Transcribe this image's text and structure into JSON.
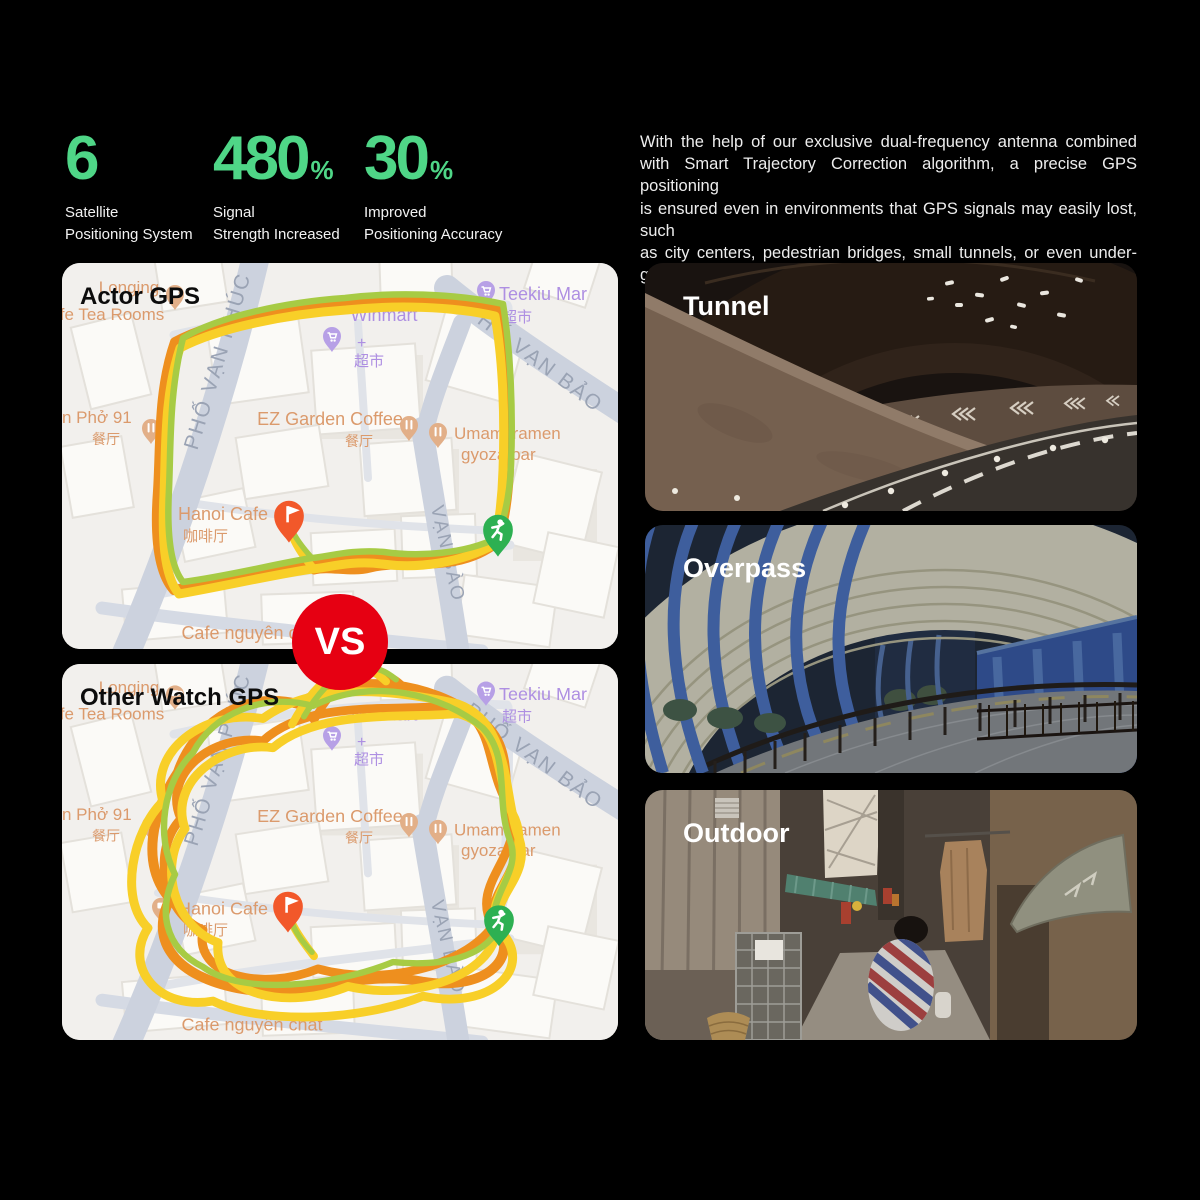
{
  "page": {
    "background": "#000000"
  },
  "stats": {
    "accent_color": "#4fd687",
    "items": [
      {
        "value": "6",
        "suffix": "",
        "label": "Satellite\nPositioning System"
      },
      {
        "value": "480",
        "suffix": "%",
        "label": "Signal\nStrength Increased"
      },
      {
        "value": "30",
        "suffix": "%",
        "label": "Improved\nPositioning Accuracy"
      }
    ]
  },
  "intro": {
    "lines": [
      "With the help of our exclusive dual-frequency antenna combined",
      "with Smart Trajectory Correction algorithm, a precise GPS positioning",
      "is ensured even in environments that GPS signals may easily lost, such",
      "as city centers, pedestrian bridges, small tunnels, or even under-",
      "ground passages."
    ]
  },
  "comparison": {
    "vs": "VS",
    "vs_color": "#e60012",
    "map_top": {
      "title": "Actor GPS"
    },
    "map_bottom": {
      "title": "Other Watch GPS"
    }
  },
  "map_pois": {
    "longing1": "Longing",
    "longing2": "fe Tea Rooms",
    "winmart": "Winmart",
    "winmart_plus": "+",
    "winmart_cn": "超市",
    "teekiu": "Teekiu Mar",
    "teekiu_cn": "超市",
    "pho": "n Phở 91",
    "pho_cn": "餐厅",
    "ez": "EZ Garden Coffee",
    "ez_cn": "餐厅",
    "umami1": "Umami ramen",
    "umami2": "gyoza bar",
    "hanoi": "Hanoi Cafe",
    "hanoi_cn": "咖啡厅",
    "cafe_nguyen": "Cafe nguyên chất",
    "street_phuc": "PHỐ VẠN PHÚC",
    "street_bao": "PHỐ VẠN BẢO",
    "street_bao2": "VẠN BÀO"
  },
  "scenes": [
    {
      "label": "Tunnel"
    },
    {
      "label": "Overpass"
    },
    {
      "label": "Outdoor"
    }
  ],
  "colors": {
    "track_yellow": "#f8cf28",
    "track_orange": "#ee8f1e",
    "track_green": "#a7cb44",
    "pin_flag": "#f2582a",
    "pin_runner": "#2db052",
    "map_poi_orange": "#db9a6c",
    "map_poi_purple": "#ae8fe2",
    "map_street_gray": "#9aa3b4"
  }
}
